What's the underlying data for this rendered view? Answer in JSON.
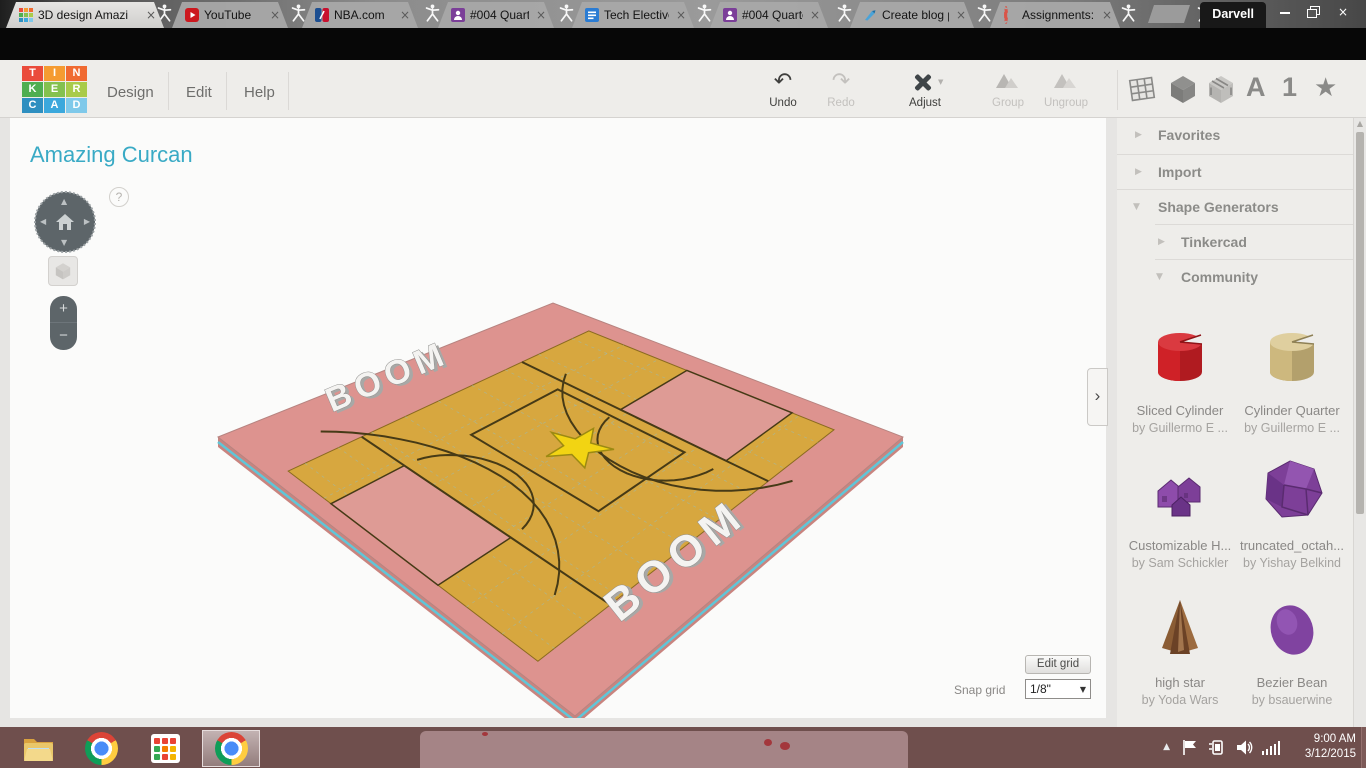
{
  "browser": {
    "profile_name": "Darvell",
    "tabs": [
      {
        "label": "3D design Amazi"
      },
      {
        "label": "YouTube"
      },
      {
        "label": "NBA.com"
      },
      {
        "label": "#004 Quarter 3 P"
      },
      {
        "label": "Tech Elective Pro"
      },
      {
        "label": "#004 Quarter 3 P"
      },
      {
        "label": "Create blog post"
      },
      {
        "label": "Assignments: TE"
      }
    ],
    "url_scheme": "https",
    "url_rest": "://www.tinkercad.com/things/6N6xhSTWGQ4-amazing-curcan/edit",
    "extension_label": "C",
    "bookmark_star": "☆"
  },
  "app": {
    "logo_letters": [
      "T",
      "I",
      "N",
      "K",
      "E",
      "R",
      "C",
      "A",
      "D"
    ],
    "menu": {
      "design": "Design",
      "edit": "Edit",
      "help": "Help"
    },
    "toolbar": {
      "undo": "Undo",
      "redo": "Redo",
      "adjust": "Adjust",
      "group": "Group",
      "ungroup": "Ungroup"
    },
    "header_icons": {
      "letter_shapes": "A",
      "number_shapes": "1",
      "symbol_shapes": "★"
    }
  },
  "glyphs": {
    "close": "×",
    "collapsed": "▶",
    "expanded": "▼",
    "caret": "▼",
    "undo": "↶",
    "redo": "↷",
    "tray_up": "▲",
    "nav_up": "▲",
    "nav_down": "▼",
    "nav_left": "◀",
    "nav_right": "▶"
  },
  "canvas": {
    "title": "Amazing Curcan",
    "help_glyph": "?",
    "zoom_in": "+",
    "zoom_out": "−",
    "collapse_panel": "›",
    "edit_grid": "Edit grid",
    "snap_grid_label": "Snap grid",
    "snap_grid_value": "1/8\"",
    "model_text": "BOOM"
  },
  "sidebar": {
    "sections": [
      {
        "label": "Favorites",
        "glyph": "▶"
      },
      {
        "label": "Import",
        "glyph": "▶"
      },
      {
        "label": "Shape Generators",
        "glyph": "▼"
      },
      {
        "label": "Tinkercad",
        "glyph": "▶"
      },
      {
        "label": "Community",
        "glyph": "▼"
      }
    ],
    "shapes": [
      {
        "name": "Sliced Cylinder",
        "author": "by Guillermo E ..."
      },
      {
        "name": "Cylinder Quarter",
        "author": "by Guillermo E ..."
      },
      {
        "name": "Customizable H...",
        "author": "by Sam Schickler"
      },
      {
        "name": "truncated_octah...",
        "author": "by Yishay Belkind"
      },
      {
        "name": "high star",
        "author": "by Yoda Wars"
      },
      {
        "name": "Bezier Bean",
        "author": "by bsauerwine"
      }
    ]
  },
  "taskbar": {
    "time": "9:00 AM",
    "date": "3/12/2015"
  },
  "model": {
    "corners": {
      "L": [
        208,
        319
      ],
      "T": [
        543,
        185
      ],
      "R": [
        893,
        319
      ],
      "B": [
        565,
        598
      ]
    },
    "colors": {
      "base": "#dd938f",
      "base_side": "#c9847f",
      "edge_cyan": "#5fc6d8",
      "court": "#d7a73f",
      "key": "#de9b95",
      "line": "#463a16",
      "grid": "#8fbfca",
      "star": "#f2d413",
      "star_edge": "#9c8a12",
      "text_fill": "#f4f3f1",
      "text_edge": "#8f8f8d",
      "text_shadow": "#a8a8a6"
    },
    "court_rect": [
      0.05,
      0.15,
      0.95,
      0.85
    ],
    "keys": [
      [
        0.05,
        0.27,
        0.27,
        0.57
      ],
      [
        0.75,
        0.43,
        0.95,
        0.73
      ]
    ],
    "center_box": [
      0.46,
      0.28,
      0.72,
      0.64
    ],
    "lines": [
      0.27,
      0.75
    ],
    "arcs": [
      {
        "c": [
          0.28,
          0.42
        ],
        "r": 0.15,
        "a0": -80,
        "a1": 80
      },
      {
        "c": [
          0.74,
          0.58
        ],
        "r": 0.15,
        "a0": 100,
        "a1": 260
      },
      {
        "c": [
          0.02,
          0.42
        ],
        "r": 0.38,
        "a0": -60,
        "a1": 60
      },
      {
        "c": [
          0.98,
          0.57
        ],
        "r": 0.38,
        "a0": 122,
        "a1": 238
      }
    ],
    "star": {
      "c": [
        0.59,
        0.46
      ],
      "r_outer": 0.075,
      "r_inner": 0.03
    },
    "labels": [
      {
        "pos": [
          0.46,
          0.055
        ],
        "rotate": -23,
        "size": 34,
        "spacing": 6
      },
      {
        "pos": [
          0.44,
          0.9
        ],
        "rotate": -38.5,
        "size": 44,
        "spacing": 7
      }
    ],
    "grid_p": [
      0.1,
      0.2,
      0.3,
      0.4,
      0.5,
      0.6,
      0.7,
      0.8,
      0.9
    ],
    "grid_q": [
      0.25,
      0.35,
      0.45,
      0.55,
      0.65,
      0.75
    ]
  }
}
